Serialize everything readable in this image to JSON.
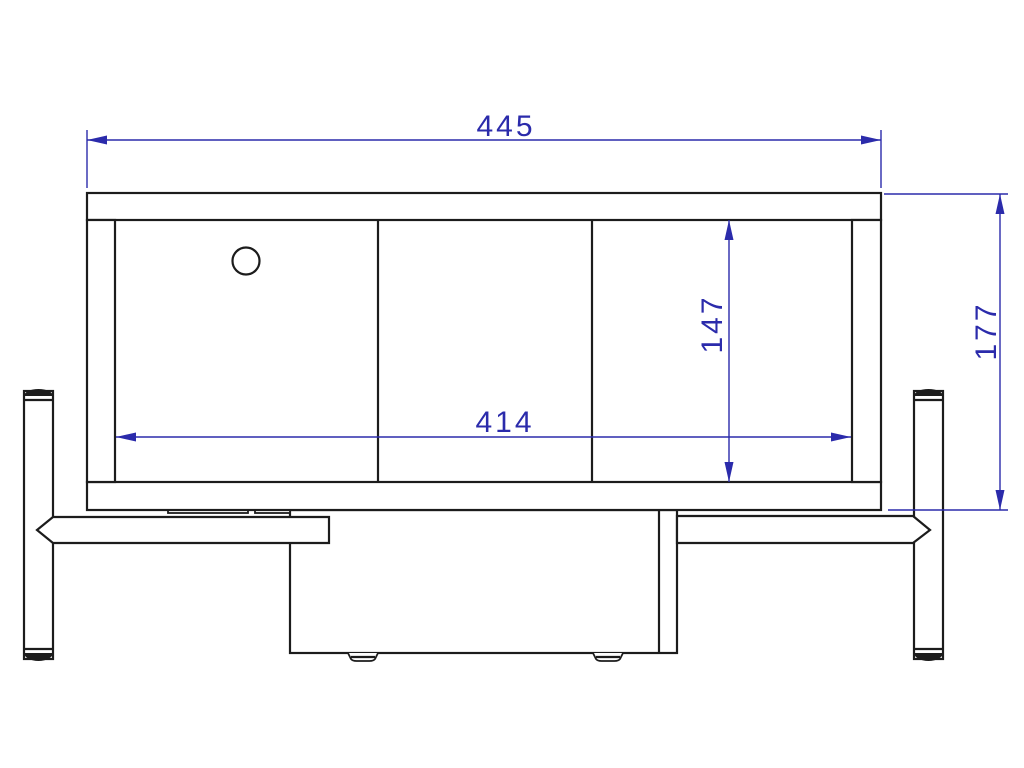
{
  "drawing": {
    "type": "furniture-technical-drawing-front-view",
    "colors": {
      "background": "#ffffff",
      "outline": "#1c1c1c",
      "dimension": "#2b2bab"
    },
    "dimensions": {
      "overall_width": {
        "label": "445",
        "orientation": "horizontal"
      },
      "inner_width": {
        "label": "414",
        "orientation": "horizontal"
      },
      "inner_height": {
        "label": "147",
        "orientation": "vertical"
      },
      "overall_height": {
        "label": "177",
        "orientation": "vertical"
      }
    },
    "features": {
      "cable_hole": "circle",
      "shelf_sections": 3,
      "legs": 2,
      "drawer_feet": 2
    }
  }
}
